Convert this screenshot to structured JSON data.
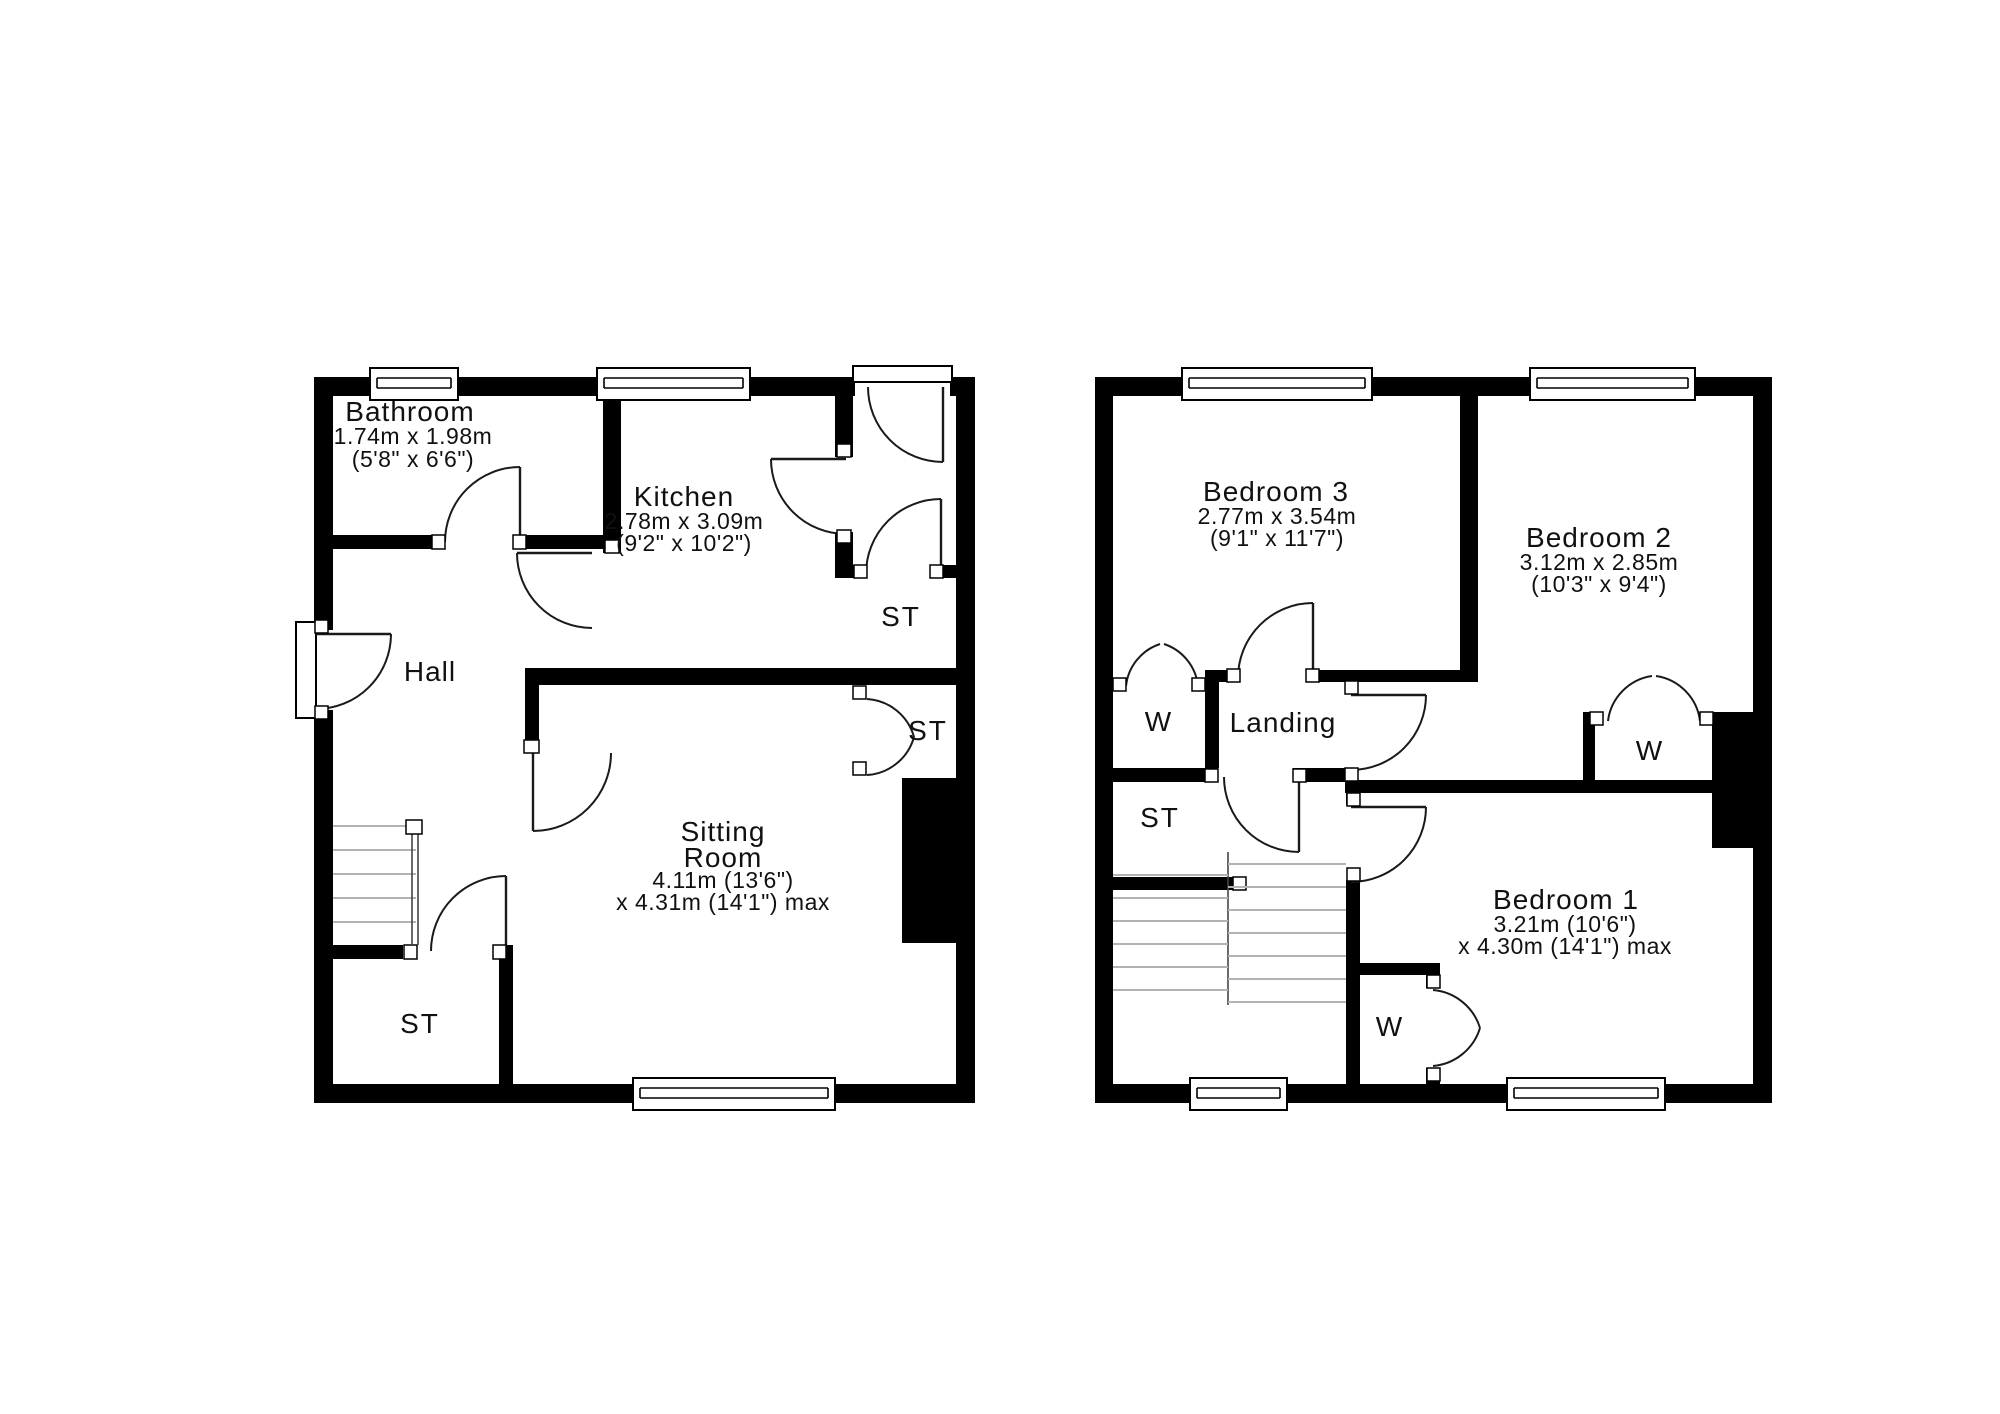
{
  "ground_floor": {
    "rooms": {
      "bathroom": {
        "name": "Bathroom",
        "dim_metric": "1.74m x 1.98m",
        "dim_imperial": "(5'8\" x 6'6\")"
      },
      "kitchen": {
        "name": "Kitchen",
        "dim_metric": "2.78m x 3.09m",
        "dim_imperial": "(9'2\" x 10'2\")"
      },
      "hall": {
        "name": "Hall"
      },
      "sitting_room": {
        "name_line1": "Sitting",
        "name_line2": "Room",
        "dim_line1": "4.11m (13'6\")",
        "dim_line2": "x 4.31m (14'1\") max"
      },
      "store_lobby": {
        "name": "ST"
      },
      "store_mid": {
        "name": "ST"
      },
      "store_understairs": {
        "name": "ST"
      }
    }
  },
  "first_floor": {
    "rooms": {
      "bedroom3": {
        "name": "Bedroom 3",
        "dim_metric": "2.77m x 3.54m",
        "dim_imperial": "(9'1\" x 11'7\")"
      },
      "bedroom2": {
        "name": "Bedroom 2",
        "dim_metric": "3.12m x 2.85m",
        "dim_imperial": "(10'3\" x 9'4\")"
      },
      "bedroom1": {
        "name": "Bedroom 1",
        "dim_line1": "3.21m (10'6\")",
        "dim_line2": "x 4.30m (14'1\") max"
      },
      "landing": {
        "name": "Landing"
      },
      "store": {
        "name": "ST"
      },
      "wardrobe_bed3": {
        "name": "W"
      },
      "wardrobe_bed2": {
        "name": "W"
      },
      "wardrobe_bed1": {
        "name": "W"
      }
    }
  },
  "colors": {
    "wall": "#000000",
    "background": "#ffffff",
    "line": "#1a1a1a"
  }
}
